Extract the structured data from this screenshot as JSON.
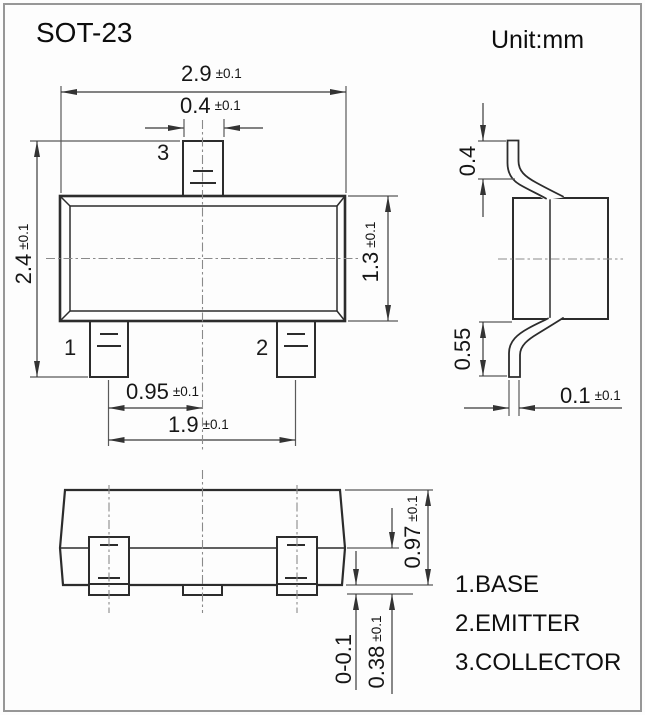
{
  "header": {
    "title": "SOT-23",
    "unit_label": "Unit:mm"
  },
  "top_view": {
    "pin1_label": "1",
    "pin2_label": "2",
    "pin3_label": "3",
    "dim_body_width": {
      "value": "2.9",
      "tol": "±0.1"
    },
    "dim_pin_width": {
      "value": "0.4",
      "tol": "±0.1"
    },
    "dim_overall_depth": {
      "value": "2.4",
      "tol": "±0.1"
    },
    "dim_body_depth": {
      "value": "1.3",
      "tol": "±0.1"
    },
    "dim_pin_pitch": {
      "value": "0.95",
      "tol": "±0.1"
    },
    "dim_pin_span": {
      "value": "1.9",
      "tol": "±0.1"
    }
  },
  "side_view": {
    "dim_lead_top_height": {
      "value": "0.4"
    },
    "dim_lead_bottom_height": {
      "value": "0.55"
    },
    "dim_lead_thickness": {
      "value": "0.1",
      "tol": "±0.1"
    }
  },
  "front_view": {
    "dim_overall_height": {
      "value": "0.97",
      "tol": "±0.1"
    },
    "dim_lead_foot_height": {
      "value": "0.38",
      "tol": "±0.1"
    },
    "dim_standoff": {
      "value": "0-0.1"
    }
  },
  "legend": {
    "items": [
      "1.BASE",
      "2.EMITTER",
      "3.COLLECTOR"
    ]
  }
}
